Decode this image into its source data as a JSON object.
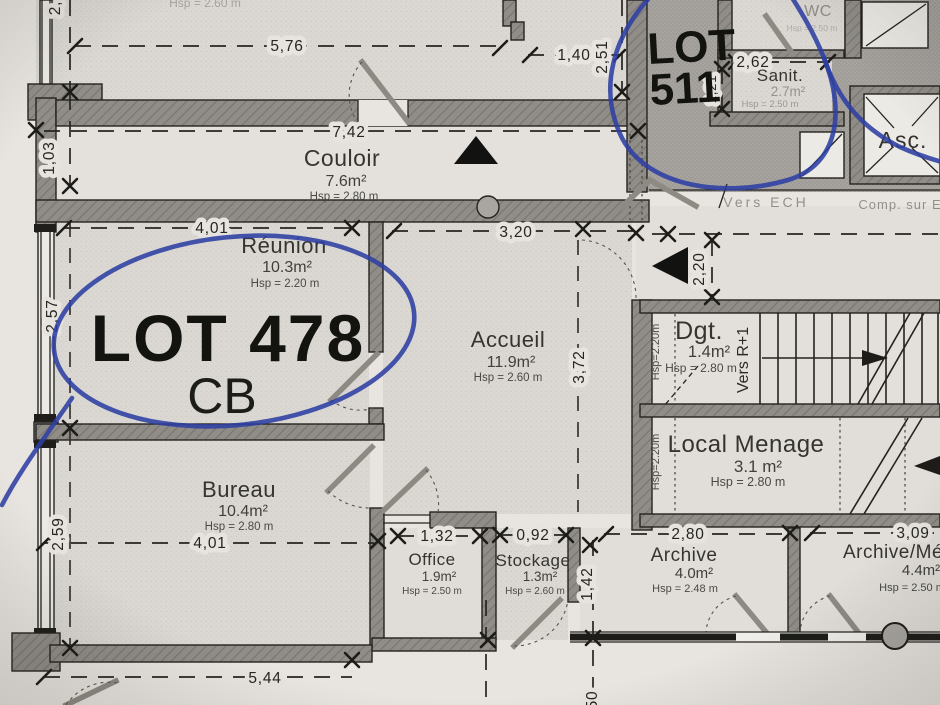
{
  "colors": {
    "pen_blue": "#2e3fa3",
    "paper": "#e8e5e1",
    "room_fill": "#dcd9d4",
    "common_fill": "#a7a4a0",
    "wall_fill": "#8f8c87",
    "ink": "#26251f"
  },
  "annotations": {
    "lot478_line1": "LOT 478",
    "lot478_line2": "CB",
    "lot511_line1": "LOT",
    "lot511_line2": "511"
  },
  "rooms": {
    "couloir": {
      "name": "Couloir",
      "area": "7.6m²",
      "hsp": "Hsp = 2.80 m"
    },
    "reunion": {
      "name": "Réunion",
      "area": "10.3m²",
      "hsp": "Hsp = 2.20 m"
    },
    "accueil": {
      "name": "Accueil",
      "area": "11.9m²",
      "hsp": "Hsp = 2.60 m"
    },
    "bureau": {
      "name": "Bureau",
      "area": "10.4m²",
      "hsp": "Hsp = 2.80 m"
    },
    "office": {
      "name": "Office",
      "area": "1.9m²",
      "hsp": "Hsp = 2.50 m"
    },
    "stockage": {
      "name": "Stockage",
      "area": "1.3m²",
      "hsp": "Hsp = 2.60 m"
    },
    "archive": {
      "name": "Archive",
      "area": "4.0m²",
      "hsp": "Hsp = 2.48 m"
    },
    "archive_menage": {
      "name": "Archive/Mé",
      "area": "4.4m²",
      "hsp": "Hsp = 2.50 m"
    },
    "local_menage": {
      "name": "Local Menage",
      "area": "3.1 m²",
      "hsp": "Hsp = 2.80 m"
    },
    "dgt": {
      "name": "Dgt.",
      "area": "1.4m²",
      "hsp": "Hsp = 2.80 m"
    },
    "sanit": {
      "name": "Sanit.",
      "area": "2.7m²",
      "hsp": "Hsp = 2.50 m"
    },
    "wc": {
      "name": "WC",
      "hsp": "Hsp = 2.50 m"
    },
    "asc": {
      "name": "Asc."
    }
  },
  "labels": {
    "vers_r1": "Vers R+1",
    "hsp_220_stair": "Hsp=2.20m",
    "hsp_220_menage": "Hsp=2.20m",
    "vers_ech": "Vers ECH",
    "comp_sur": "Comp. sur E",
    "hsp_top_partial": "Hsp = 2.60 m"
  },
  "dimensions": {
    "d576": "5,76",
    "d140": "1,40",
    "d251": "2,51",
    "d103": "1,03",
    "d742": "7,42",
    "d401_reunion": "4,01",
    "d320": "3,20",
    "d220": "2,20",
    "d257": "2,57",
    "d372": "3,72",
    "d262": "2,62",
    "d121": "1,21",
    "d259": "2,59",
    "d401_bureau": "4,01",
    "d132": "1,32",
    "d092": "0,92",
    "d142": "1,42",
    "d280": "2,80",
    "d309": "3,09",
    "d544": "5,44",
    "d150_partial": "50",
    "d2_partial": "2,"
  }
}
